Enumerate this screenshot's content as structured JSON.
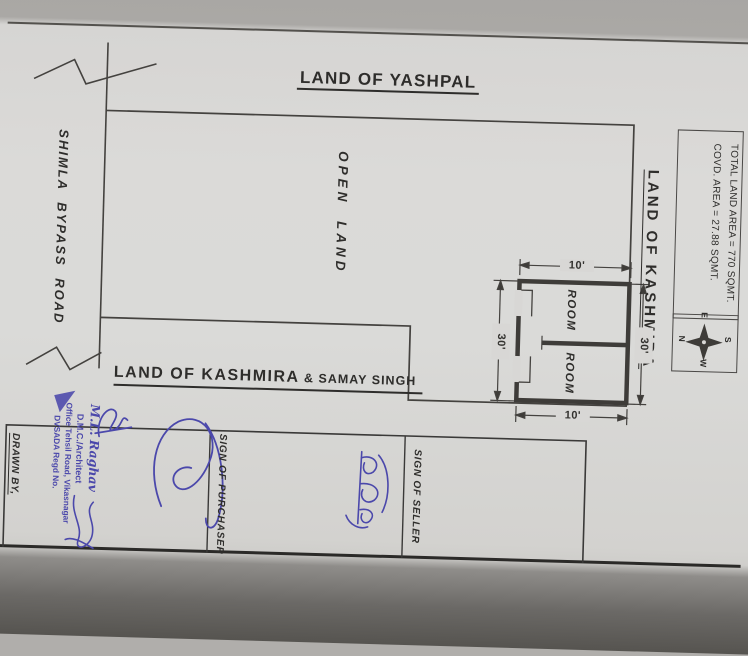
{
  "plan": {
    "north_neighbor": "LAND OF YASHPAL",
    "road": "SHIMLA BYPASS ROAD",
    "open_land": "OPEN LAND",
    "east_neighbor": "LAND OF KASHMIRA",
    "south_neighbor_primary": "LAND OF KASHMIRA",
    "south_neighbor_secondary": "& SAMAY SINGH",
    "room_top": "ROOM",
    "room_bottom": "ROOM",
    "dim_width_top": "10'",
    "dim_width_bottom": "10'",
    "dim_height_left": "30'",
    "dim_height_right": "30'"
  },
  "info_box": {
    "line1": "TOTAL LAND AREA = 770 SQMT.",
    "line2": "COVD. AREA = 27.88 SQMT."
  },
  "compass": {
    "top": "E",
    "left": "N",
    "right": "S",
    "bottom": "W"
  },
  "signatures": {
    "drawn_by": "DRAWN BY,",
    "purchaser": "SIGN OF PURCHASER",
    "seller": "SIGN OF SELLER",
    "stamp_name": "M.L. Raghav",
    "stamp_title": "D.M.C./Architect",
    "stamp_address": "Office Tehsil Road, Vikasnagar",
    "stamp_regd": "DVSADA Regd No.",
    "seller_script": "समय सिंह"
  },
  "colors": {
    "ink_blue": "#4b48ab",
    "line": "#3e3c39",
    "paper": "#d8d7d5"
  }
}
